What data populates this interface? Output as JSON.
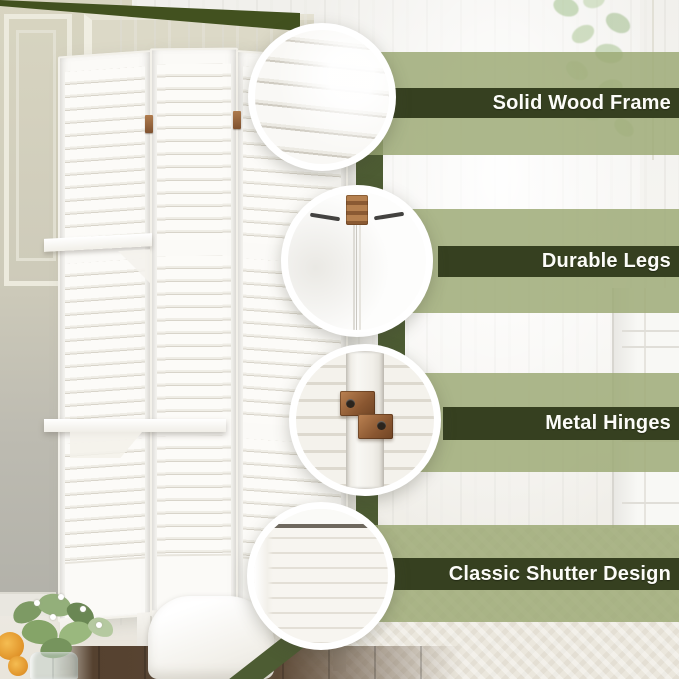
{
  "features": [
    {
      "label": "Solid Wood Frame",
      "callout_icon": "louvered-slats-closeup-icon"
    },
    {
      "label": "Durable Legs",
      "callout_icon": "panel-frame-corner-closeup-icon"
    },
    {
      "label": "Metal Hinges",
      "callout_icon": "copper-hinge-closeup-icon"
    },
    {
      "label": "Classic Shutter Design",
      "callout_icon": "shutter-slats-closeup-icon"
    }
  ],
  "colors": {
    "band_dark": "#364020",
    "band_light": "#aab58a",
    "ribbon_green": "#4d5c33",
    "label_text": "#fcfcf8",
    "hinge_copper": "#8a5a33",
    "product_white": "#fbfaf7"
  },
  "product": {
    "type": "3-panel louvered room divider",
    "finish": "white"
  }
}
